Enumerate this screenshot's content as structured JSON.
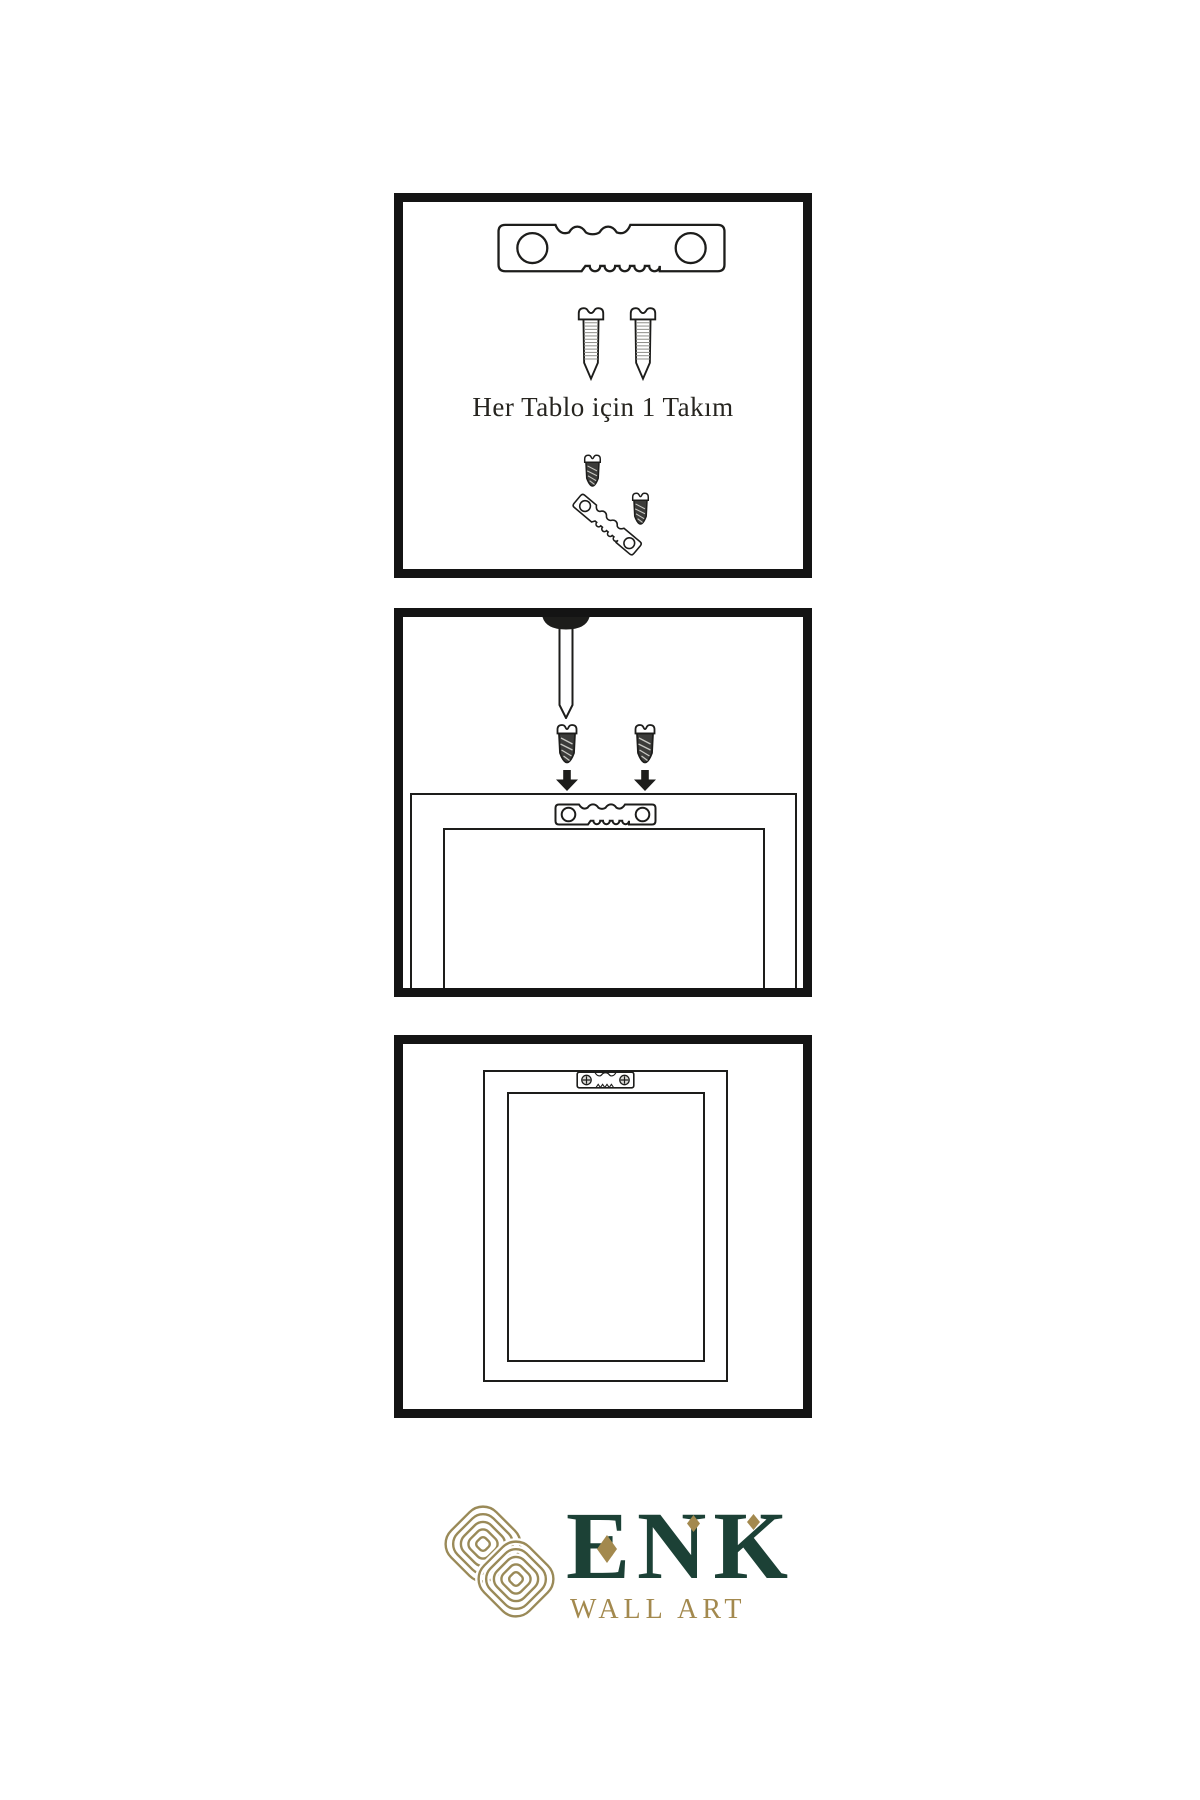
{
  "colors": {
    "line": "#1d1d1b",
    "panel_border": "#141414",
    "screw_dark": "#3c3c3a",
    "brand_green": "#1c4136",
    "brand_gold": "#a3894e",
    "knot_gold": "#9a8a58",
    "background": "#ffffff"
  },
  "step1": {
    "caption": "Her Tablo için 1 Takım",
    "icons": [
      "sawtooth-hanger",
      "mounting-screw",
      "mounting-screw",
      "screw-into-hanger-assembly"
    ]
  },
  "step2": {
    "icons": [
      "wall-nail",
      "dark-screw",
      "dark-screw",
      "down-arrow",
      "down-arrow",
      "frame-back-with-sawtooth-hanger"
    ]
  },
  "step3": {
    "icons": [
      "hung-picture-frame",
      "sawtooth-hanger-with-screws"
    ]
  },
  "brand": {
    "name": "ENK",
    "subtitle": "WALL ART"
  }
}
